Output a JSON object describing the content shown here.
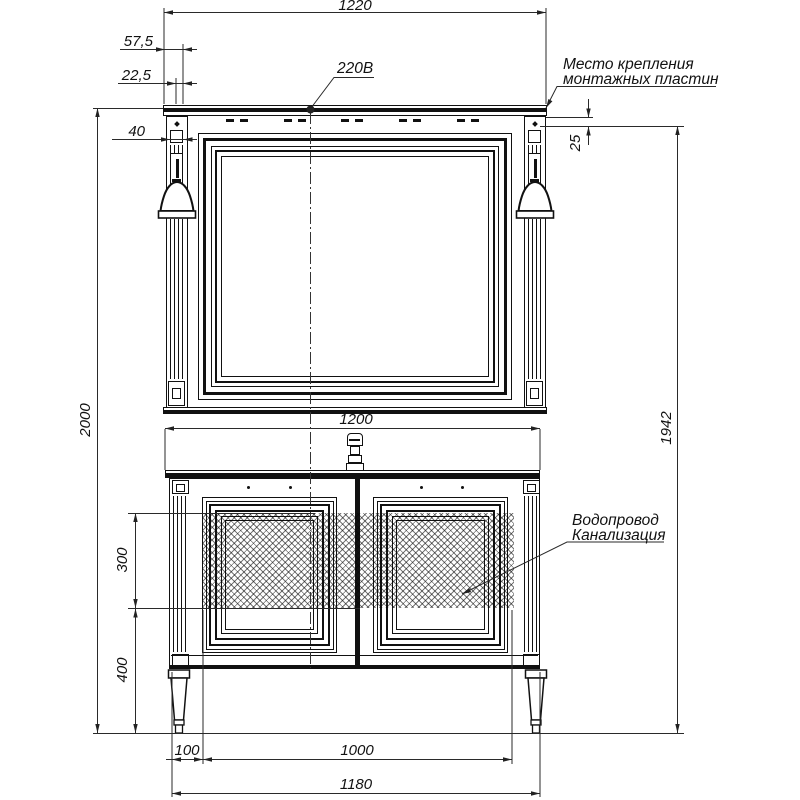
{
  "dimensions": {
    "top_width": "1220",
    "lamp_offset_outer": "57,5",
    "lamp_offset_inner": "22,5",
    "column_width": "40",
    "plate_gap": "25",
    "overall_height": "2000",
    "mounting_height": "1942",
    "cabinet_width": "1200",
    "pipe_zone_height": "300",
    "pipe_zone_floor_offset": "400",
    "side_offset": "100",
    "pipe_zone_width": "1000",
    "base_width": "1180"
  },
  "labels": {
    "voltage": "220В",
    "mounting_line1": "Место крепления",
    "mounting_line2": "монтажных пластин",
    "plumbing_line1": "Водопровод",
    "plumbing_line2": "Канализация"
  }
}
